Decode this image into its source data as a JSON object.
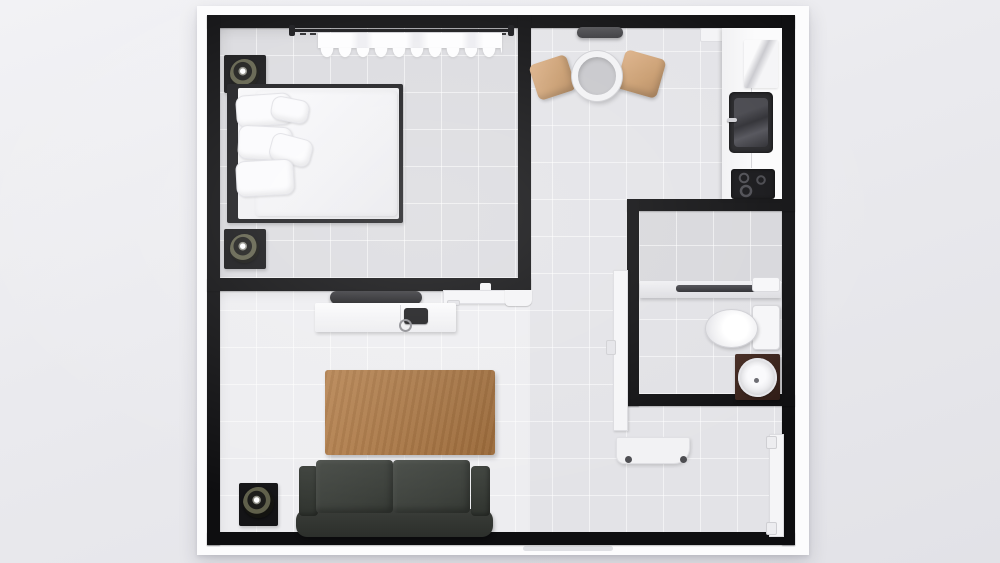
{
  "meta": {
    "title": "Studio apartment 3D floor plan, top-down view",
    "view": "top-down render",
    "visible_text": ""
  },
  "palette": {
    "background": "#eaeaee",
    "slab": "#fcfcfd",
    "wall": "#0e0e10",
    "floor_light": "#ededf0",
    "floor_mid": "#e3e3e7",
    "floor_dark": "#dbdbdf",
    "shower_floor": "#d7d7db",
    "wood_table": "#ac7239",
    "chair_wood": "#c89b6d",
    "sofa": "#3b3f3a",
    "vanity_wood": "#38211c",
    "appliance_dark": "#1a1a1d"
  },
  "rooms": {
    "bedroom": {
      "label": "Bedroom"
    },
    "kitchen": {
      "label": "Kitchen and dining area"
    },
    "bathroom": {
      "label": "Bathroom"
    },
    "living": {
      "label": "Living room"
    },
    "entry": {
      "label": "Entry hallway"
    }
  },
  "furniture": {
    "curtain_rod": {
      "label": "Curtain rod"
    },
    "curtain": {
      "label": "Window curtain"
    },
    "nightstand": {
      "label": "Nightstand"
    },
    "table_lamp": {
      "label": "Round table lamp"
    },
    "bed": {
      "label": "Double bed with white bedding"
    },
    "pillow": {
      "label": "Pillow"
    },
    "duvet": {
      "label": "Duvet"
    },
    "wall_switch": {
      "label": "Wall switch"
    },
    "bedroom_door": {
      "label": "Bedroom door (open)"
    },
    "door_jamb": {
      "label": "Door jamb"
    },
    "wall_shelf_dark": {
      "label": "Wall shelf"
    },
    "wall_shelf_white": {
      "label": "Wall shelf"
    },
    "tall_cabinet": {
      "label": "Kitchen cabinet"
    },
    "kitchen_counter": {
      "label": "Kitchen counter"
    },
    "kitchen_sink": {
      "label": "Kitchen sink with faucet"
    },
    "cooktop": {
      "label": "Cooktop with burners"
    },
    "dining_table": {
      "label": "Round dining table"
    },
    "dining_chair": {
      "label": "Wooden dining chair"
    },
    "shower_shelf": {
      "label": "Shower ledge"
    },
    "shower_bar": {
      "label": "Shower glass partition rail"
    },
    "shower_tray": {
      "label": "Bathroom tray"
    },
    "toilet": {
      "label": "Toilet"
    },
    "vanity": {
      "label": "Vanity cabinet"
    },
    "vanity_sink": {
      "label": "Round wash basin"
    },
    "bathroom_door": {
      "label": "Bathroom door (open)"
    },
    "entry_door": {
      "label": "Entry door (closed)"
    },
    "desk": {
      "label": "Wall-mounted desk"
    },
    "tv": {
      "label": "Television"
    },
    "tv_console": {
      "label": "TV console"
    },
    "phone": {
      "label": "Telephone"
    },
    "coffee_table": {
      "label": "Wooden coffee table"
    },
    "sofa": {
      "label": "Three-seat sofa"
    },
    "side_table": {
      "label": "Side table"
    },
    "doormat": {
      "label": "Entrance threshold"
    }
  }
}
